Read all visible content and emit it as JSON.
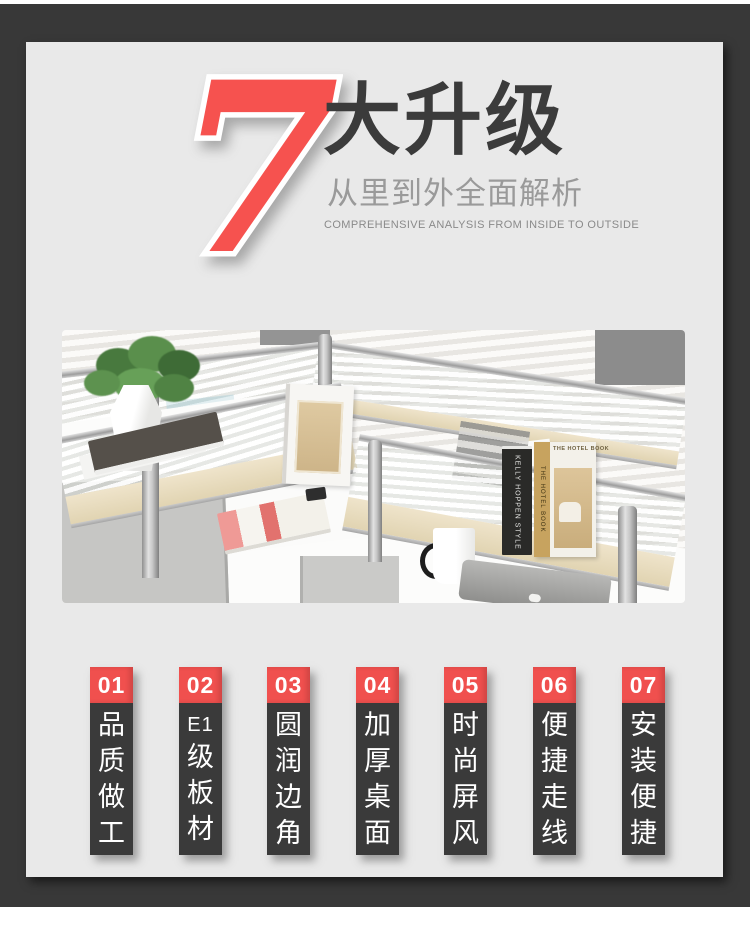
{
  "colors": {
    "frame_dark": "#383838",
    "panel_gray": "#e9e9e9",
    "accent_red": "#f0504e",
    "seven_red": "#f6524f",
    "feature_body_dark": "#3a3a3a"
  },
  "header": {
    "big_number": "7",
    "title": "大升级",
    "subtitle": "从里到外全面解析",
    "subtitle_en": "COMPREHENSIVE ANALYSIS FROM INSIDE TO OUTSIDE"
  },
  "photo": {
    "book_spine_black": "KELLY HOPPEN STYLE",
    "book_spine_tan": "THE HOTEL BOOK",
    "book_cover_title": "THE HOTEL BOOK"
  },
  "features": [
    {
      "number": "01",
      "label": "品质做工",
      "chars": [
        "品",
        "质",
        "做",
        "工"
      ]
    },
    {
      "number": "02",
      "label": "E1级板材",
      "chars": [
        "E1",
        "级",
        "板",
        "材"
      ]
    },
    {
      "number": "03",
      "label": "圆润边角",
      "chars": [
        "圆",
        "润",
        "边",
        "角"
      ]
    },
    {
      "number": "04",
      "label": "加厚桌面",
      "chars": [
        "加",
        "厚",
        "桌",
        "面"
      ]
    },
    {
      "number": "05",
      "label": "时尚屏风",
      "chars": [
        "时",
        "尚",
        "屏",
        "风"
      ]
    },
    {
      "number": "06",
      "label": "便捷走线",
      "chars": [
        "便",
        "捷",
        "走",
        "线"
      ]
    },
    {
      "number": "07",
      "label": "安装便捷",
      "chars": [
        "安",
        "装",
        "便",
        "捷"
      ]
    }
  ]
}
